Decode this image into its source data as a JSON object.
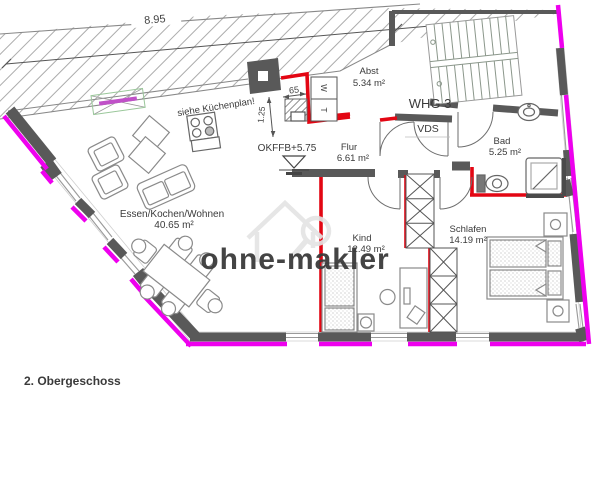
{
  "plan": {
    "floor_title": "2. Obergeschoss",
    "watermark": "ohne-makler",
    "note_kitchen": "siehe Küchenplan!",
    "apartment_label": "WHG 3",
    "shaft_label": "VDS",
    "level_label": "OKFFB+5.75",
    "dim_total": "8.95",
    "dim_shaft": "65",
    "dim_kitchen": "1.25",
    "washer": "W",
    "dryer": "T",
    "rooms": {
      "living": {
        "name": "Essen/Kochen/Wohnen",
        "area": "40.65 m²"
      },
      "storage": {
        "name": "Abst",
        "area": "5.34 m²"
      },
      "hall": {
        "name": "Flur",
        "area": "6.61 m²"
      },
      "bath": {
        "name": "Bad",
        "area": "5.25 m²"
      },
      "child": {
        "name": "Kind",
        "area": "12.49 m²"
      },
      "bedroom": {
        "name": "Schlafen",
        "area": "14.19 m²"
      }
    },
    "colors": {
      "outer_wall": "#595959",
      "insulation": "#ee00ee",
      "red_wall": "#e30613",
      "stairs": "#8b978b",
      "watermark": "#e4e4e4",
      "skylight_green": "#9ac79a",
      "skylight_bar": "#c050c8"
    }
  }
}
